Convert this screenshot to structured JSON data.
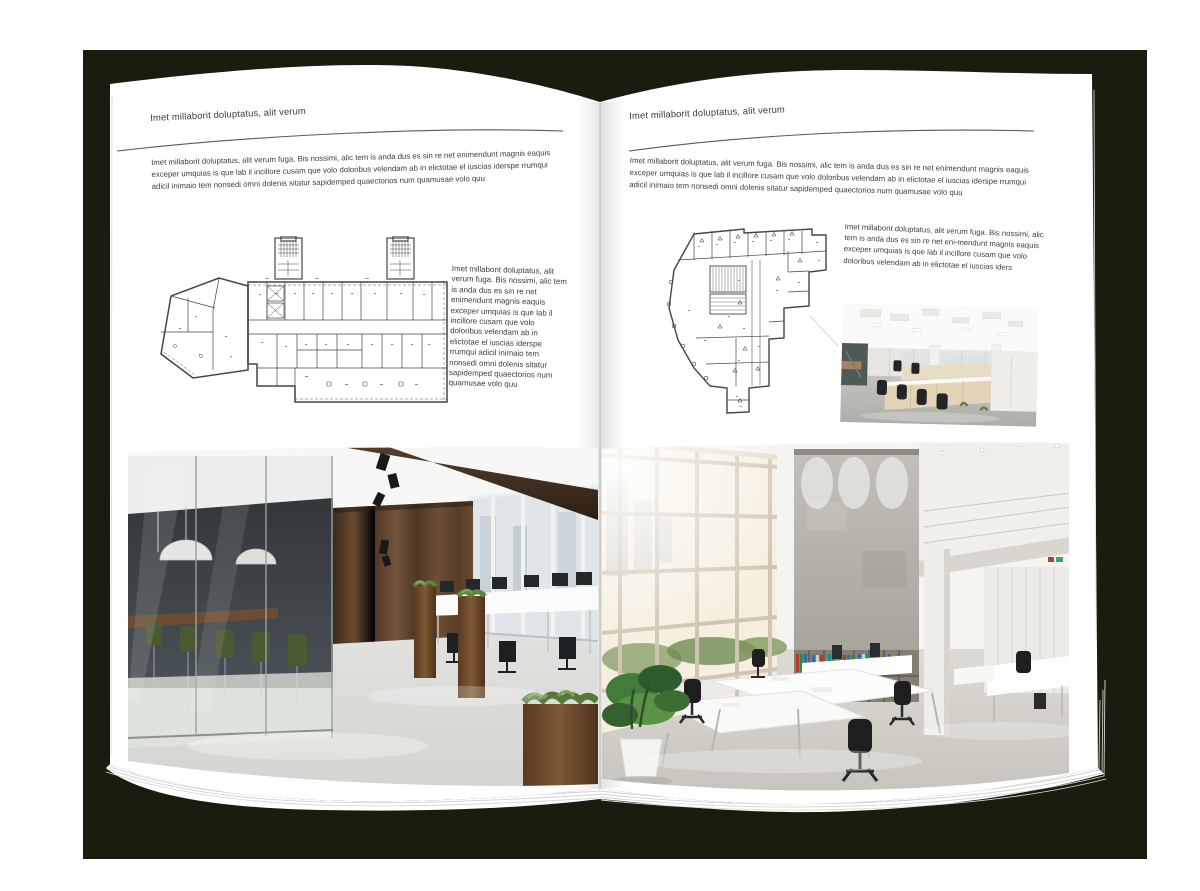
{
  "backdrop": {
    "color": "#1b1c0e",
    "page_color": "#ffffff"
  },
  "left_page": {
    "header": "Imet millaborit doluptatus, alit verum",
    "intro": "Imet millaborit doluptatus, alit verum fuga. Bis nossimi, alic tem is anda dus es sin re net enimendunt magnis eaquis exceper umquias is que lab il incillore cusam que volo doloribus velendam ab in elictotae el iuscias iderspe rrumqui adicil inimaio tem nonsedi omni dolenis sitatur sapidemped quaectorios num quamusae volo quu",
    "side_text": "Imet millaborit doluptatus, alit verum fuga. Bis nossimi, alic tem is anda dus es sin re net enimendunt magnis eaquis exceper umquias is que lab il incillore cusam que volo doloribus velendam ab in elictotae el iuscias iderspe rrumqui adicil inimaio tem nonsedi omni dolenis sitatur sapidemped quaectorios num quamusae volo quu"
  },
  "right_page": {
    "header": "Imet millaborit doluptatus, alit verum",
    "intro": "Imet millaborit doluptatus, alit verum fuga. Bis nossimi, alic tem is anda dus es sin re net enimendunt magnis eaquis exceper umquias is que lab il incillore cusam que volo doloribus velendam ab in elictotae el iuscias iderspe rrumqui adicil inimaio tem nonsedi omni dolenis sitatur sapidemped quaectorios num quamusae volo quu",
    "side_text": "Imet millaborit doluptatus, alit verum fuga. Bis nossimi, alic tem is anda dus es sin re net eni-mendunt magnis eaquis exceper umquias is que lab il incillore cusam que volo doloribus velendam ab in elictotae el iuscias iders"
  }
}
